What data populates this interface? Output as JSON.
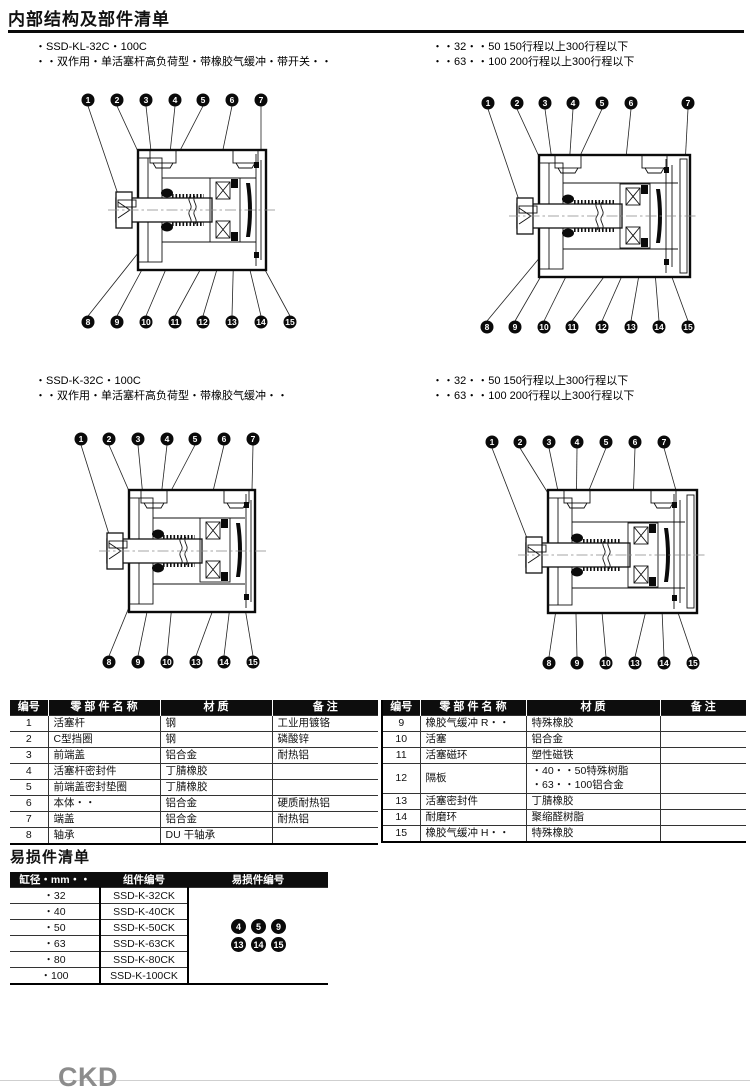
{
  "page": {
    "title": "内部结构及部件清单",
    "footer_logo": "CKD"
  },
  "sections": [
    {
      "model": "・SSD-KL-32C・100C",
      "desc": "・・双作用・单活塞杆高负荷型・带橡胶气缓冲・带开关・・",
      "note1": "・・32・・50 150行程以上300行程以下",
      "note2": "・・63・・100 200行程以上300行程以下"
    },
    {
      "model": "・SSD-K-32C・100C",
      "desc": "・・双作用・单活塞杆高负荷型・带橡胶气缓冲・・",
      "note1": "・・32・・50 150行程以上300行程以下",
      "note2": "・・63・・100 200行程以上300行程以下"
    }
  ],
  "diagrams": [
    {
      "name": "ssd-kl-standard",
      "top": [
        "1",
        "2",
        "3",
        "4",
        "5",
        "6",
        "7"
      ],
      "bottom": [
        "8",
        "9",
        "10",
        "11",
        "12",
        "13",
        "14",
        "15"
      ]
    },
    {
      "name": "ssd-kl-long-stroke",
      "top": [
        "1",
        "2",
        "3",
        "4",
        "5",
        "6",
        "7"
      ],
      "bottom": [
        "8",
        "9",
        "10",
        "11",
        "12",
        "13",
        "14",
        "15"
      ]
    },
    {
      "name": "ssd-k-standard",
      "top": [
        "1",
        "2",
        "3",
        "4",
        "5",
        "6",
        "7"
      ],
      "bottom": [
        "8",
        "9",
        "10",
        "13",
        "14",
        "15"
      ]
    },
    {
      "name": "ssd-k-long-stroke",
      "top": [
        "1",
        "2",
        "3",
        "4",
        "5",
        "6",
        "7"
      ],
      "bottom": [
        "8",
        "9",
        "10",
        "13",
        "14",
        "15"
      ]
    }
  ],
  "parts_table": {
    "headers": [
      "编号",
      "零 部 件 名 称",
      "材 质",
      "备 注"
    ],
    "left_rows": [
      {
        "no": "1",
        "name": "活塞杆",
        "material": "钢",
        "note": "工业用镀铬"
      },
      {
        "no": "2",
        "name": "C型挡圈",
        "material": "钢",
        "note": "磷酸锌"
      },
      {
        "no": "3",
        "name": "前端盖",
        "material": "铝合金",
        "note": "耐热铝"
      },
      {
        "no": "4",
        "name": "活塞杆密封件",
        "material": "丁腈橡胶",
        "note": ""
      },
      {
        "no": "5",
        "name": "前端盖密封垫圈",
        "material": "丁腈橡胶",
        "note": ""
      },
      {
        "no": "6",
        "name": "本体・・",
        "material": "铝合金",
        "note": "硬质耐热铝"
      },
      {
        "no": "7",
        "name": "端盖",
        "material": "铝合金",
        "note": "耐热铝"
      },
      {
        "no": "8",
        "name": "轴承",
        "material": "DU 干轴承",
        "note": ""
      }
    ],
    "right_rows": [
      {
        "no": "9",
        "name": "橡胶气缓冲 R・・",
        "material": "特殊橡胶",
        "note": ""
      },
      {
        "no": "10",
        "name": "活塞",
        "material": "铝合金",
        "note": ""
      },
      {
        "no": "11",
        "name": "活塞磁环",
        "material": "塑性磁铁",
        "note": ""
      },
      {
        "no": "12",
        "name": "隔板",
        "material_line1": "・40・・50特殊树脂",
        "material_line2": "・63・・100铝合金",
        "note": ""
      },
      {
        "no": "13",
        "name": "活塞密封件",
        "material": "丁腈橡胶",
        "note": ""
      },
      {
        "no": "14",
        "name": "耐磨环",
        "material": "聚缩醛树脂",
        "note": ""
      },
      {
        "no": "15",
        "name": "橡胶气缓冲 H・・",
        "material": "特殊橡胶",
        "note": ""
      }
    ]
  },
  "wear_parts": {
    "title": "易损件清单",
    "headers": [
      "缸径・mm・・",
      "组件编号",
      "易损件编号"
    ],
    "rows": [
      {
        "bore": "・32",
        "kit": "SSD-K-32CK"
      },
      {
        "bore": "・40",
        "kit": "SSD-K-40CK"
      },
      {
        "bore": "・50",
        "kit": "SSD-K-50CK"
      },
      {
        "bore": "・63",
        "kit": "SSD-K-63CK"
      },
      {
        "bore": "・80",
        "kit": "SSD-K-80CK"
      },
      {
        "bore": "・100",
        "kit": "SSD-K-100CK"
      }
    ],
    "badge_rows": [
      [
        "4",
        "5",
        "9"
      ],
      [
        "13",
        "14",
        "15"
      ]
    ]
  }
}
